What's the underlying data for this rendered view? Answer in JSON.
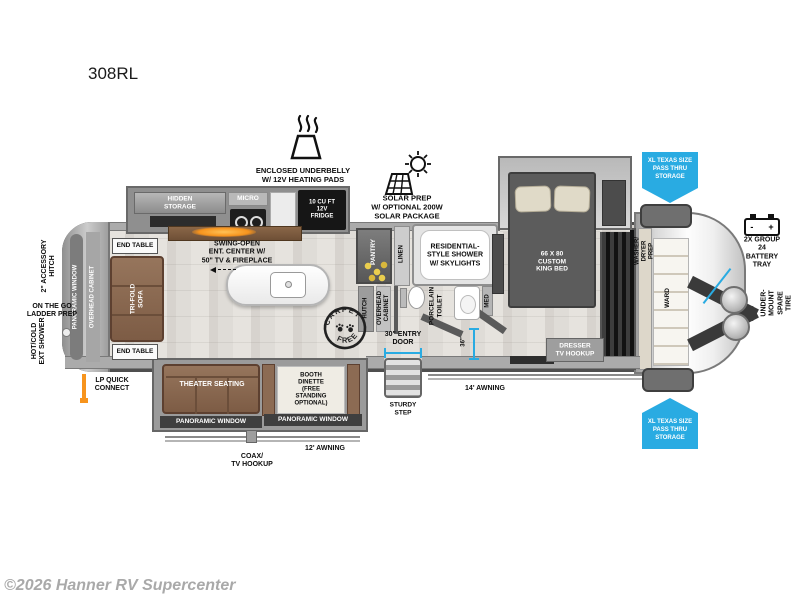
{
  "title": "308RL",
  "watermark": "©2026 Hanner RV Supercenter",
  "colors": {
    "accent_blue": "#29abe2",
    "orange": "#f7941d"
  },
  "features": {
    "underbelly": "ENCLOSED UNDERBELLY\nW/ 12V HEATING PADS",
    "solar": "SOLAR PREP\nW/ OPTIONAL 200W\nSOLAR PACKAGE"
  },
  "exterior": {
    "accessory_hitch": "2\" ACCESSORY\nHITCH",
    "ladder_prep": "ON THE GO\nLADDER PREP",
    "ext_shower": "HOT/COLD\nEXT SHOWER",
    "lp_connect": "LP QUICK\nCONNECT",
    "entry_door": "30\" ENTRY\nDOOR",
    "door_width": "36\"",
    "sturdy_step": "STURDY\nSTEP",
    "awning_14": "14' AWNING",
    "awning_12": "12' AWNING",
    "coax": "COAX/\nTV HOOKUP",
    "pass_thru_top": "XL TEXAS SIZE\nPASS THRU\nSTORAGE",
    "pass_thru_bottom": "XL TEXAS SIZE\nPASS THRU\nSTORAGE",
    "battery": "2X GROUP 24\nBATTERY\nTRAY",
    "battery_terminals": "-      +",
    "spare_tire": "UNDER-MOUNT\nSPARE TIRE"
  },
  "rear": {
    "panoramic_window": "PANORAMIC WINDOW",
    "overhead_cabinet": "OVERHEAD CABINET"
  },
  "living": {
    "end_table_top": "END TABLE",
    "end_table_bottom": "END TABLE",
    "sofa": "TRI-FOLD\nSOFA",
    "ent_center": "SWING-OPEN\nENT. CENTER W/\n50\" TV & FIREPLACE",
    "theater": "THEATER SEATING",
    "dinette": "BOOTH\nDINETTE\n(FREE\nSTANDING\nOPTIONAL)",
    "window_left": "PANORAMIC WINDOW",
    "window_right": "PANORAMIC WINDOW"
  },
  "kitchen": {
    "hidden_storage": "HIDDEN\nSTORAGE",
    "micro": "MICRO",
    "fridge": "10 CU FT\n12V\nFRIDGE",
    "pantry": "PANTRY",
    "hutch": "HUTCH",
    "overhead_cabinet": "OVERHEAD\nCABINET",
    "carpet_free_top": "CARPET",
    "carpet_free_bottom": "FREE"
  },
  "bath": {
    "linen": "LINEN",
    "shower": "RESIDENTIAL-\nSTYLE SHOWER\nW/ SKYLIGHTS",
    "toilet": "PORCELAIN\nTOILET",
    "med": "MED"
  },
  "bedroom": {
    "bed": "66 X 80\nCUSTOM\nKING BED",
    "dresser": "DRESSER\nTV HOOKUP",
    "washer_dryer": "WASHER/\nDRYER\nPREP",
    "ward": "WARD"
  }
}
